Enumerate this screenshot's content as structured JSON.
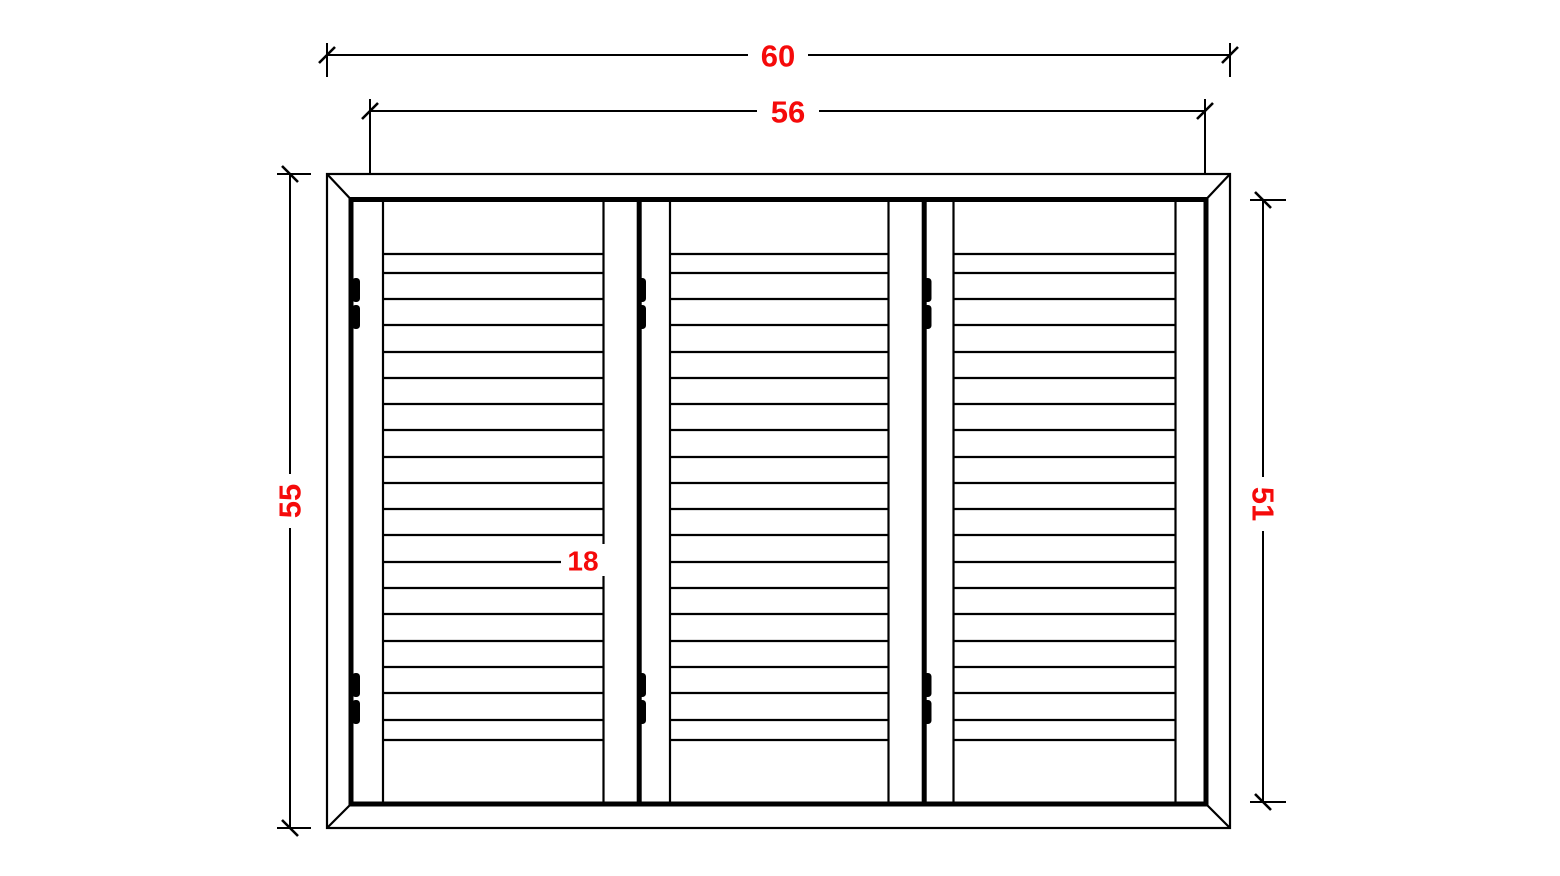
{
  "drawing": {
    "title": "Three-panel louvered shutter elevation",
    "colors": {
      "background": "#ffffff",
      "line": "#000000",
      "dimension_text": "#f50a0a"
    },
    "dimensions": {
      "overall_width": "60",
      "inner_width": "56",
      "overall_height": "55",
      "inner_height": "51",
      "panel_width": "18"
    },
    "panels": {
      "count": 3,
      "louver_lines_per_panel": 20,
      "hinges_per_panel": 2
    }
  }
}
